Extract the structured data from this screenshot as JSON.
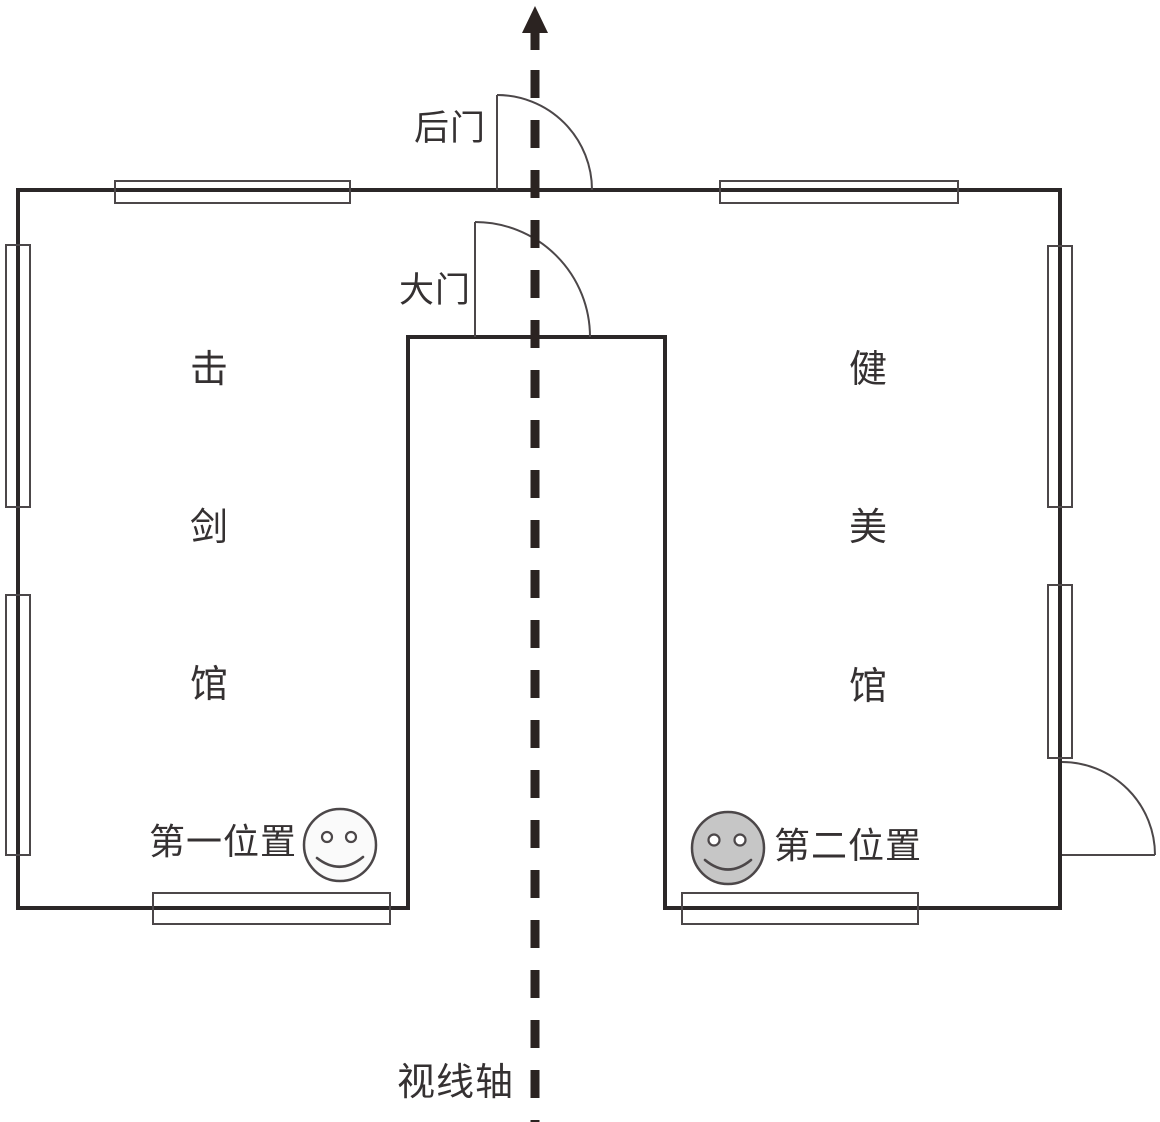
{
  "colors": {
    "background": "#ffffff",
    "wall": "#2b2728",
    "thin_line": "#4c4749",
    "text": "#353132",
    "axis": "#2b2321",
    "smiley_left_fill": "#fafafa",
    "smiley_right_fill": "#c6c6c6"
  },
  "labels": {
    "back_door": "后门",
    "main_door": "大门",
    "sight_axis": "视线轴"
  },
  "rooms": {
    "left": {
      "name": "击剑馆",
      "chars": [
        "击",
        "剑",
        "馆"
      ]
    },
    "right": {
      "name": "健美馆",
      "chars": [
        "健",
        "美",
        "馆"
      ]
    }
  },
  "positions": {
    "first": {
      "label": "第一位置",
      "marker_icon": "smiley-face"
    },
    "second": {
      "label": "第二位置",
      "marker_icon": "smiley-face"
    }
  }
}
